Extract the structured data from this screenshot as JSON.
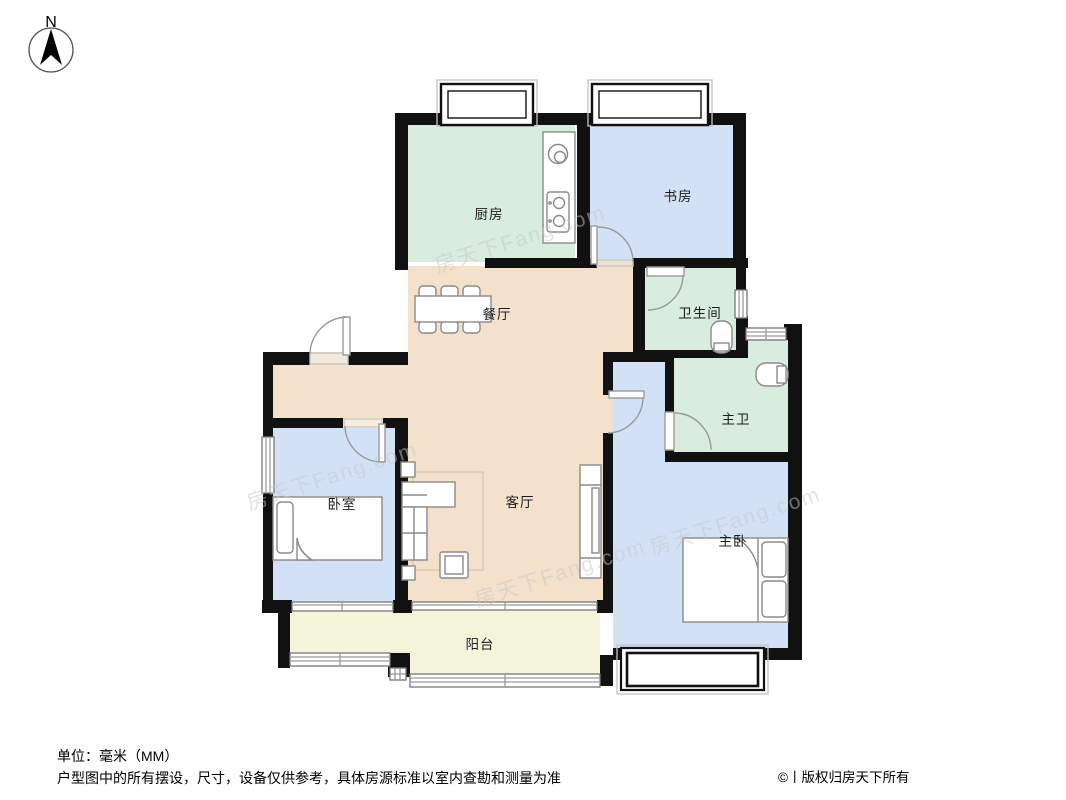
{
  "compass": {
    "label": "N"
  },
  "rooms": {
    "kitchen": {
      "label": "厨房"
    },
    "study": {
      "label": "书房"
    },
    "bathroom": {
      "label": "卫生间"
    },
    "dining": {
      "label": "餐厅"
    },
    "living": {
      "label": "客厅"
    },
    "bedroom": {
      "label": "卧室"
    },
    "master_bath": {
      "label": "主卫"
    },
    "master_bedroom": {
      "label": "主卧"
    },
    "balcony": {
      "label": "阳台"
    }
  },
  "watermark": {
    "text": "房天下Fang.com"
  },
  "footer": {
    "unit_note": "单位：毫米（MM）",
    "disclaimer": "户型图中的所有摆设，尺寸，设备仅供参考，具体房源标准以室内查勘和测量为准",
    "copyright": "©丨版权归房天下所有"
  },
  "colors": {
    "wall": "#111111",
    "mint": "#d8ece0",
    "blue": "#d3e1f7",
    "tan": "#f3e1cb",
    "cream": "#f4f4db",
    "furniture_outline": "#8a8a8a",
    "glass": "#9a9a9a",
    "watermark": "#c9c9c9"
  }
}
